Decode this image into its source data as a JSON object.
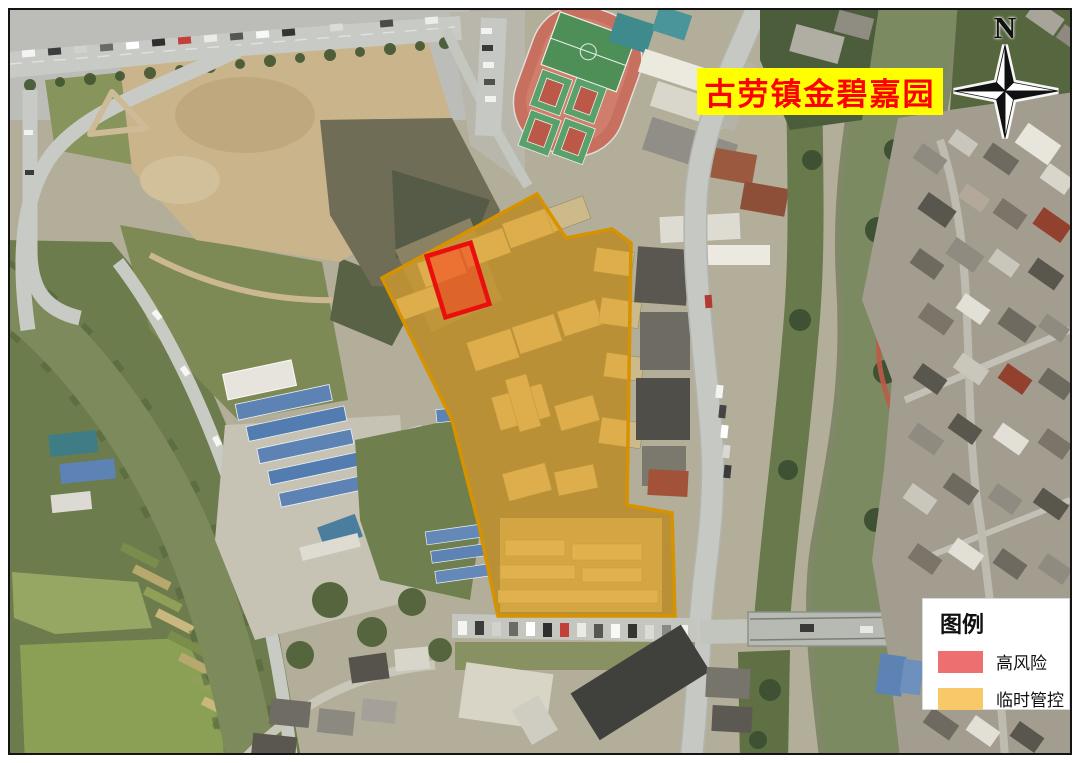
{
  "banner": {
    "text": "古劳镇金碧嘉园",
    "bg_color": "#ffff00",
    "text_color": "#ff0000"
  },
  "compass": {
    "label": "N"
  },
  "legend": {
    "title": "图例",
    "items": [
      {
        "key": "high-risk",
        "label": "高风险",
        "color": "#ee6f70"
      },
      {
        "key": "temp-control",
        "label": "临时管控",
        "color": "#f7c969"
      }
    ]
  },
  "overlays": {
    "temp_control_zone": {
      "label": "临时管控",
      "fill": "#e8a51e",
      "fill_opacity": "0.58",
      "stroke": "#d79200",
      "stroke_width": "3.5"
    },
    "high_risk_zone": {
      "label": "高风险",
      "fill": "#ff2a17",
      "fill_opacity": "0.45",
      "stroke": "#ea0f0f",
      "stroke_width": "4.5"
    }
  }
}
